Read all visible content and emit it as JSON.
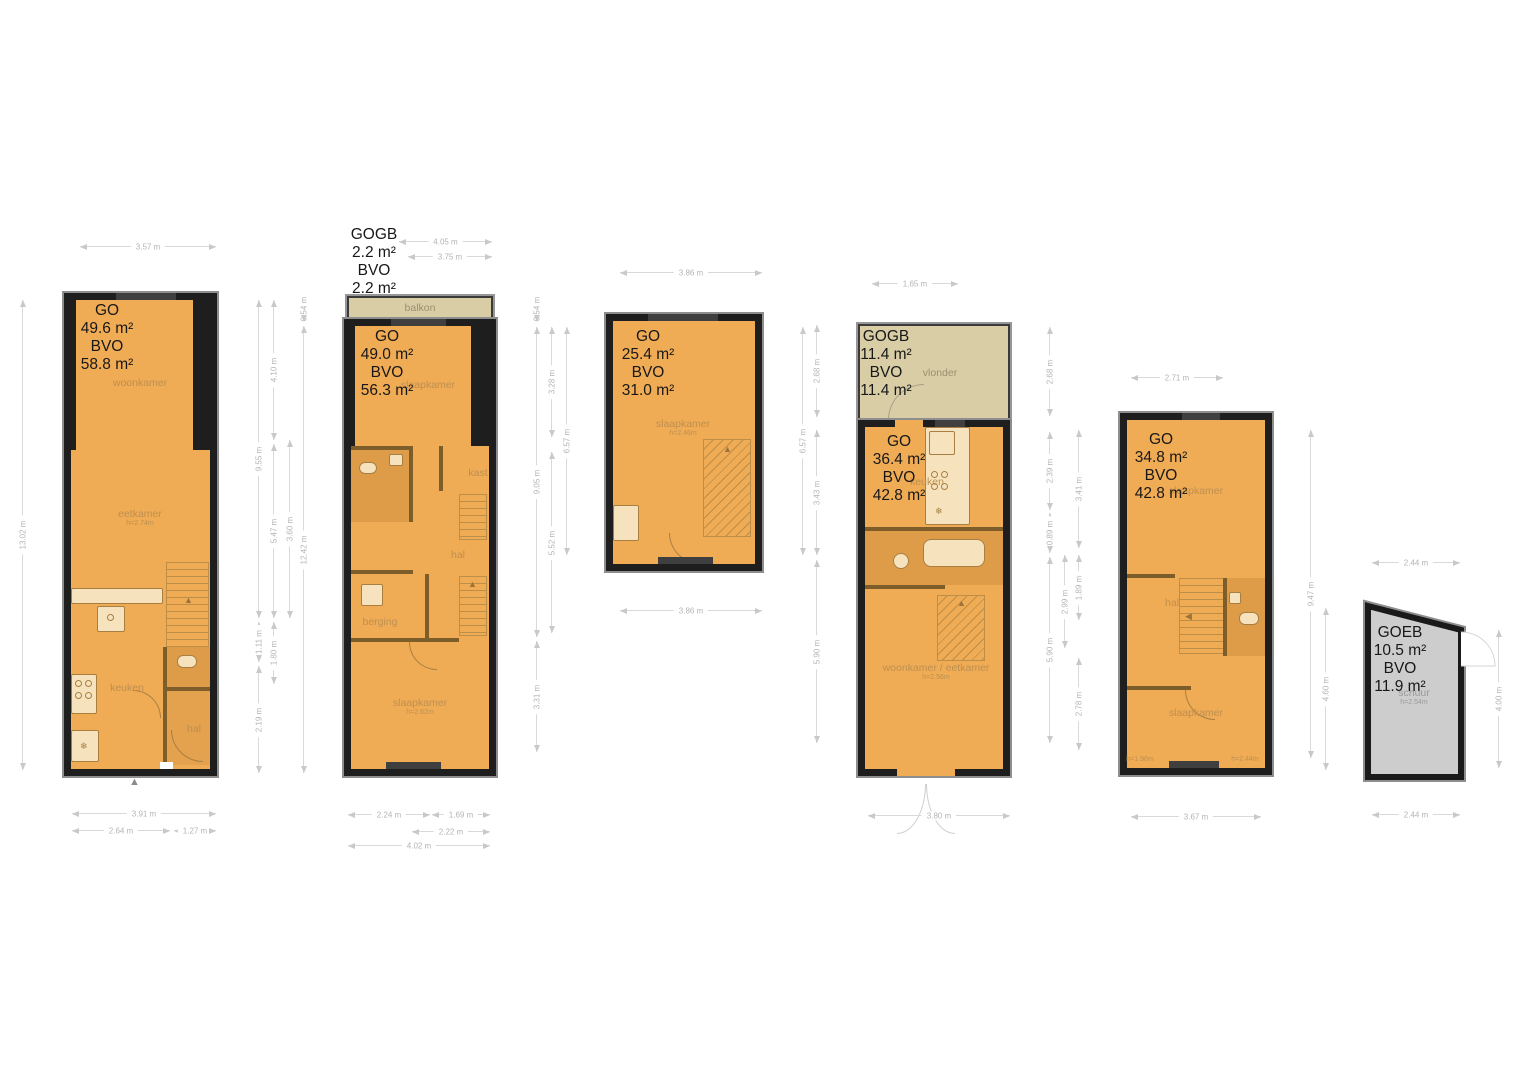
{
  "colors": {
    "floor": "#f0ab55",
    "wall": "#1e1e1e",
    "outer_outline": "#8e8e8e",
    "deck": "#d9cda6",
    "shed": "#cdcdcd",
    "dim_text": "#b4b4b4",
    "room_label": "#bd9050",
    "area_text": "#181818"
  },
  "units": [
    {
      "name": "unit-1",
      "area": {
        "l1": "GO",
        "l2": "49.6 m²",
        "l3": "BVO",
        "l4": "58.8 m²"
      },
      "rooms": {
        "woonkamer": "woonkamer",
        "eetkamer": "eetkamer",
        "eetkamer_h": "h=2.74m",
        "keuken": "keuken",
        "hal": "hal"
      }
    },
    {
      "name": "unit-2",
      "gogb": {
        "l1": "GOGB",
        "l2": "2.2 m²",
        "l3": "BVO",
        "l4": "2.2 m²"
      },
      "area": {
        "l1": "GO",
        "l2": "49.0 m²",
        "l3": "BVO",
        "l4": "56.3 m²"
      },
      "rooms": {
        "balkon": "balkon",
        "slaapkamer_top": "slaapkamer",
        "kast": "kast",
        "hal": "hal",
        "berging": "berging",
        "slaapkamer": "slaapkamer",
        "slaapkamer_h": "h=2.62m"
      }
    },
    {
      "name": "unit-3",
      "area": {
        "l1": "GO",
        "l2": "25.4 m²",
        "l3": "BVO",
        "l4": "31.0 m²"
      },
      "rooms": {
        "slaapkamer": "slaapkamer",
        "slaapkamer_h": "h=2.46m"
      }
    },
    {
      "name": "unit-4",
      "gogb": {
        "l1": "GOGB",
        "l2": "11.4 m²",
        "l3": "BVO",
        "l4": "11.4 m²"
      },
      "area": {
        "l1": "GO",
        "l2": "36.4 m²",
        "l3": "BVO",
        "l4": "42.8 m²"
      },
      "rooms": {
        "vlonder": "vlonder",
        "keuken": "keuken",
        "woonkamer": "woonkamer / eetkamer",
        "woonkamer_h": "h=2.56m"
      }
    },
    {
      "name": "unit-5",
      "area": {
        "l1": "GO",
        "l2": "34.8 m²",
        "l3": "BVO",
        "l4": "42.8 m²"
      },
      "rooms": {
        "slaapkamer_top": "slaapkamer",
        "hal": "hal",
        "slaapkamer": "slaapkamer",
        "h_left": "h=1.96m",
        "h_right": "h=2.44m"
      }
    },
    {
      "name": "unit-6",
      "area": {
        "l1": "GOEB",
        "l2": "10.5 m²",
        "l3": "BVO",
        "l4": "11.9 m²"
      },
      "rooms": {
        "schuur": "schuur",
        "schuur_h": "h=2.54m"
      }
    }
  ],
  "dims": {
    "u1_top": "3.57 m",
    "u1_left": "13.02 m",
    "u1_b1": "3.91 m",
    "u1_b2": "2.64 m",
    "u1_b3": "1.27 m",
    "g1": [
      "9.55 m",
      "1.11 m",
      "2.19 m",
      "4.10 m",
      "5.47 m",
      "1.80 m",
      "3.60 m",
      "0.54 m",
      "12.42 m"
    ],
    "u2_t1": "4.05 m",
    "u2_t2": "3.75 m",
    "u2_b1": "2.24 m",
    "u2_b2": "1.69 m",
    "u2_b3": "2.22 m",
    "u2_b4": "4.02 m",
    "g2": [
      "0.54 m",
      "9.05 m",
      "3.31 m",
      "3.28 m",
      "5.52 m",
      "6.57 m"
    ],
    "u3_top": "3.86 m",
    "u3_bottom": "3.86 m",
    "g3": [
      "6.57 m",
      "2.68 m",
      "3.43 m",
      "5.90 m"
    ],
    "u4_top": "1.65 m",
    "u4_bottom": "3.80 m",
    "g4": [
      "2.68 m",
      "2.39 m",
      "0.89 m",
      "5.90 m",
      "2.99 m",
      "3.41 m",
      "1.89 m",
      "2.78 m"
    ],
    "u5_top": "2.71 m",
    "u5_bottom": "3.67 m",
    "g5": [
      "9.47 m",
      "4.60 m"
    ],
    "u6_top": "2.44 m",
    "u6_bottom": "2.44 m",
    "u6_right": "4.00 m"
  }
}
